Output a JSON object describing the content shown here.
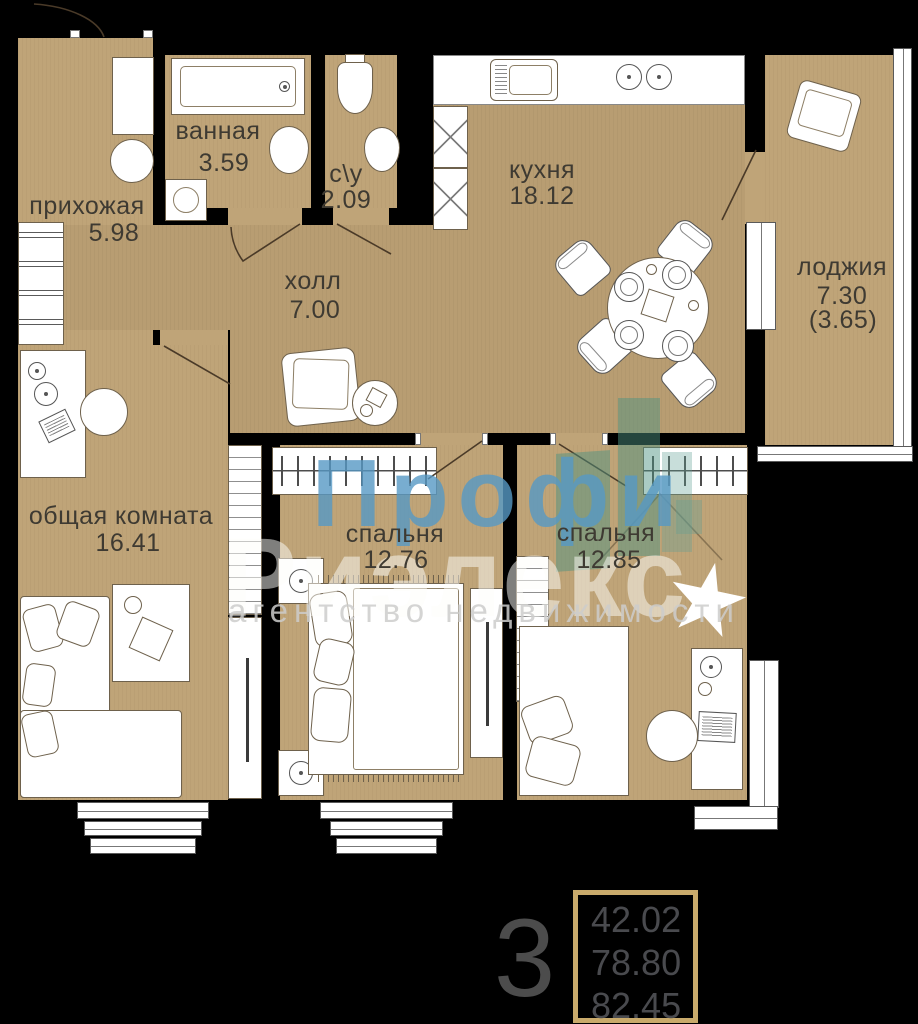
{
  "plan": {
    "rooms": [
      {
        "id": "entry",
        "name": "прихожая",
        "area": "5.98"
      },
      {
        "id": "bathroom",
        "name": "ванная",
        "area": "3.59"
      },
      {
        "id": "wc",
        "name": "с\\у",
        "area": "2.09"
      },
      {
        "id": "kitchen",
        "name": "кухня",
        "area": "18.12"
      },
      {
        "id": "hall",
        "name": "холл",
        "area": "7.00"
      },
      {
        "id": "loggia",
        "name": "лоджия",
        "area": "7.30",
        "area_reduced": "(3.65)"
      },
      {
        "id": "living",
        "name": "общая комната",
        "area": "16.41"
      },
      {
        "id": "bedroom1",
        "name": "спальня",
        "area": "12.76"
      },
      {
        "id": "bedroom2",
        "name": "спальня",
        "area": "12.85"
      }
    ]
  },
  "watermark": {
    "brand_line1": "Профи",
    "brand_line2": "Риэлекс",
    "tagline": "агентство недвижимости"
  },
  "summary": {
    "rooms_count": "3",
    "area_values": [
      "42.02",
      "78.80",
      "82.45"
    ]
  },
  "colors": {
    "background": "#000000",
    "walls": "#3b3b3b",
    "floor": "#bfa478",
    "accent_border": "#c9aa6b",
    "watermark_blue": "#5a9cc8",
    "watermark_teal": "#4d9282"
  }
}
